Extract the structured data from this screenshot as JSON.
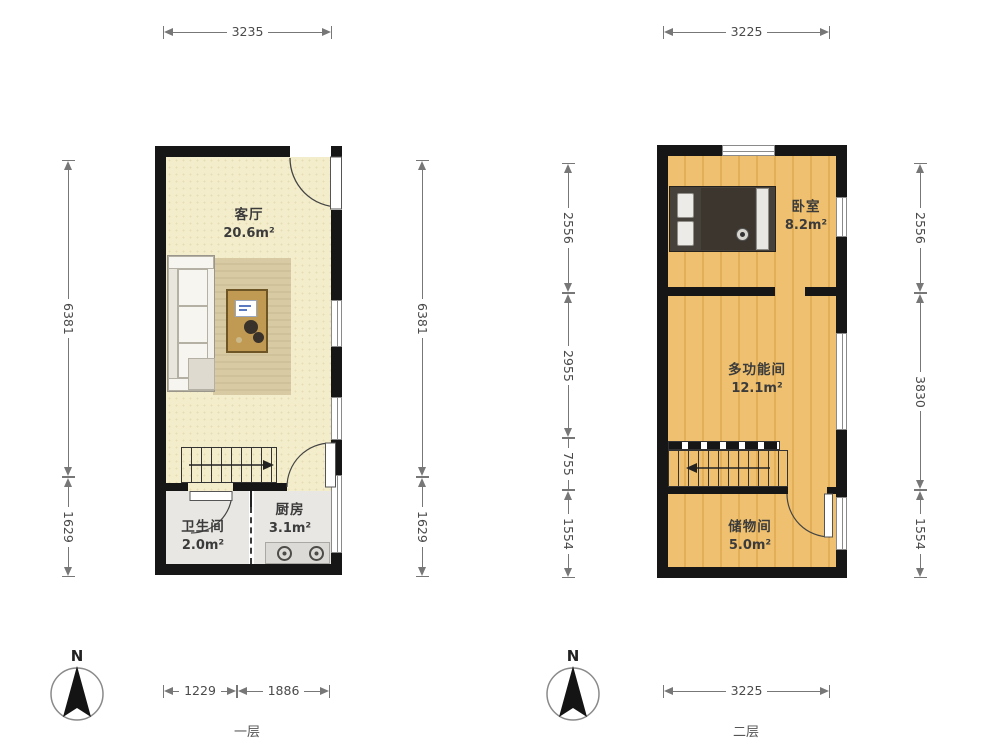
{
  "floor1": {
    "label": "一层",
    "compass": "N",
    "rooms": {
      "living": {
        "name": "客厅",
        "area": "20.6m²"
      },
      "bathroom": {
        "name": "卫生间",
        "area": "2.0m²"
      },
      "kitchen": {
        "name": "厨房",
        "area": "3.1m²"
      }
    },
    "dims": {
      "top": "3235",
      "side_upper": "6381",
      "side_lower": "1629",
      "bottom_left": "1229",
      "bottom_right": "1886"
    }
  },
  "floor2": {
    "label": "二层",
    "compass": "N",
    "rooms": {
      "bedroom": {
        "name": "卧室",
        "area": "8.2m²"
      },
      "multi": {
        "name": "多功能间",
        "area": "12.1m²"
      },
      "storage": {
        "name": "储物间",
        "area": "5.0m²"
      }
    },
    "dims": {
      "top": "3225",
      "left_upper": "2556",
      "left_mid": "2955",
      "left_small": "755",
      "left_lower": "1554",
      "right_upper": "2556",
      "right_mid": "3830",
      "right_lower": "1554",
      "bottom": "3225"
    }
  },
  "colors": {
    "wall": "#161616",
    "floor_living": "#f3edcb",
    "floor_wet": "#e8e7e3",
    "floor_wood": "#eebb69",
    "rug": "#d7c9a2",
    "dimension_line": "#777777",
    "label_text": "#3b3b3b"
  }
}
